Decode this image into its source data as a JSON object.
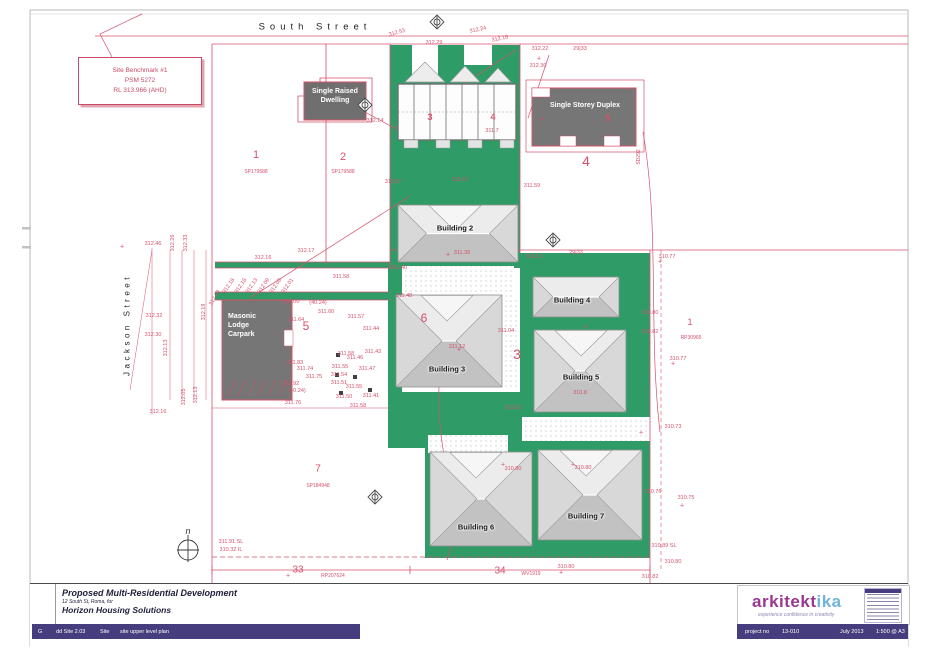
{
  "colors": {
    "line_pink": "#d6506b",
    "green": "#2f9c68",
    "dark_gray": "#767676",
    "purple_bar": "#453d7d",
    "logo_magenta": "#9a3890",
    "logo_cyan": "#72b5d8"
  },
  "plan": {
    "streets": {
      "top": "South Street",
      "left": "Jackson Street"
    },
    "benchmark": [
      "Site Benchmark #1",
      "PSM 5272",
      "RL 313.966 (AHD)"
    ],
    "areas": {
      "single_raised_dwelling": "Single Raised Dwelling",
      "single_storey_duplex": "Single Storey Duplex",
      "masonic_carpark": "Masonic Lodge Carpark"
    },
    "north_label": "n",
    "buildings": [
      {
        "label": "Building 2",
        "x": 398,
        "y": 205,
        "w": 120,
        "h": 57,
        "lx": 455,
        "ly": 228,
        "g": true
      },
      {
        "label": "Building 3",
        "x": 396,
        "y": 295,
        "w": 106,
        "h": 92,
        "lx": 447,
        "ly": 369,
        "g": true
      },
      {
        "label": "Building 4",
        "x": 533,
        "y": 277,
        "w": 86,
        "h": 40,
        "lx": 572,
        "ly": 300,
        "g": false
      },
      {
        "label": "Building 5",
        "x": 534,
        "y": 330,
        "w": 92,
        "h": 82,
        "lx": 581,
        "ly": 377,
        "g": true
      },
      {
        "label": "Building 6",
        "x": 430,
        "y": 452,
        "w": 102,
        "h": 94,
        "lx": 476,
        "ly": 527,
        "g": true
      },
      {
        "label": "Building 7",
        "x": 538,
        "y": 450,
        "w": 104,
        "h": 90,
        "lx": 586,
        "ly": 516,
        "g": true
      }
    ],
    "lot_numbers": [
      [
        "1",
        256,
        155,
        11
      ],
      [
        "2",
        343,
        157,
        11
      ],
      [
        "4",
        586,
        161,
        14
      ],
      [
        "5",
        306,
        326,
        12
      ],
      [
        "6",
        424,
        318,
        12
      ],
      [
        "3",
        517,
        354,
        14
      ],
      [
        "7",
        318,
        469,
        10
      ],
      [
        "33",
        298,
        570,
        10
      ],
      [
        "34",
        500,
        571,
        10
      ],
      [
        "1",
        690,
        322,
        9
      ]
    ],
    "plan_refs": [
      [
        "SP179588",
        256,
        172,
        0
      ],
      [
        "SP179588",
        343,
        172,
        0
      ],
      [
        "SP184948",
        318,
        486,
        0
      ],
      [
        "RP207624",
        333,
        576,
        0
      ],
      [
        "WV1919",
        531,
        574,
        0
      ],
      [
        "RP30965",
        691,
        338,
        0
      ],
      [
        "SD292",
        639,
        157,
        -90
      ]
    ],
    "unit_numbers": [
      [
        "3",
        430,
        117
      ],
      [
        "4",
        493,
        117
      ],
      [
        "5",
        608,
        118
      ]
    ],
    "survey_labels": [
      [
        "312.53",
        397,
        33,
        -15
      ],
      [
        "312.29",
        434,
        43
      ],
      [
        "312.24",
        478,
        30,
        -12
      ],
      [
        "312.16",
        500,
        39,
        -12
      ],
      [
        "312.22",
        540,
        49
      ],
      [
        "29|33",
        580,
        49
      ],
      [
        "312.30",
        538,
        66
      ],
      [
        "312.14",
        375,
        121
      ],
      [
        "311.7",
        492,
        131
      ],
      [
        "312.46",
        153,
        244
      ],
      [
        "312.26",
        173,
        243,
        -90
      ],
      [
        "312.33",
        186,
        243,
        -90
      ],
      [
        "312.16",
        263,
        258
      ],
      [
        "312.17",
        306,
        251
      ],
      [
        "311.58",
        341,
        277
      ],
      [
        "312.18",
        229,
        286,
        -55
      ],
      [
        "312.18",
        241,
        286,
        -55
      ],
      [
        "312.13",
        252,
        286,
        -55
      ],
      [
        "312.09",
        264,
        286,
        -55
      ],
      [
        "312.08",
        276,
        286,
        -55
      ],
      [
        "312.01",
        288,
        286,
        -55
      ],
      [
        "312.00",
        291,
        302
      ],
      [
        "(40.24)",
        318,
        303
      ],
      [
        "311.60",
        326,
        312
      ],
      [
        "311.64",
        296,
        320
      ],
      [
        "312.32",
        154,
        316
      ],
      [
        "312.30",
        153,
        335
      ],
      [
        "312.19",
        204,
        312,
        -90
      ],
      [
        "312.29",
        215,
        298,
        -60
      ],
      [
        "312.13",
        166,
        348,
        -90
      ],
      [
        "311.83",
        295,
        363
      ],
      [
        "311.74",
        305,
        369
      ],
      [
        "311.75",
        314,
        377
      ],
      [
        "311.92",
        291,
        384
      ],
      [
        "(40.24)",
        297,
        391
      ],
      [
        "311.76",
        293,
        403
      ],
      [
        "312.05",
        184,
        397,
        -90
      ],
      [
        "312.13",
        196,
        395,
        -90
      ],
      [
        "312.16",
        158,
        412
      ],
      [
        "311.87",
        393,
        182
      ],
      [
        "311.67",
        460,
        180
      ],
      [
        "311.59",
        532,
        186
      ],
      [
        "311.39",
        462,
        253
      ],
      [
        "311.12",
        534,
        257
      ],
      [
        "29|33",
        576,
        253
      ],
      [
        "310.77",
        667,
        257
      ],
      [
        "311.40",
        399,
        268
      ],
      [
        "311.48",
        404,
        296
      ],
      [
        "311.57",
        356,
        317
      ],
      [
        "311.44",
        371,
        329
      ],
      [
        "311.58",
        346,
        354
      ],
      [
        "311.43",
        373,
        352
      ],
      [
        "311.46",
        355,
        358
      ],
      [
        "311.55",
        340,
        367
      ],
      [
        "311.54",
        339,
        375
      ],
      [
        "311.47",
        367,
        369
      ],
      [
        "311.51",
        339,
        383
      ],
      [
        "311.55",
        354,
        387
      ],
      [
        "311.50",
        344,
        397
      ],
      [
        "311.41",
        371,
        396
      ],
      [
        "311.58",
        358,
        406
      ],
      [
        "311.12",
        457,
        347
      ],
      [
        "311.04",
        506,
        331
      ],
      [
        "311.03",
        513,
        408
      ],
      [
        "310.8",
        580,
        393
      ],
      [
        "310.80",
        650,
        313
      ],
      [
        "310.82",
        650,
        332
      ],
      [
        "310.77",
        678,
        359
      ],
      [
        "310.73",
        673,
        427
      ],
      [
        "310.76",
        653,
        492
      ],
      [
        "310.75",
        686,
        498
      ],
      [
        "310.89 SL",
        664,
        546
      ],
      [
        "310.80",
        673,
        562
      ],
      [
        "310.82",
        650,
        577
      ],
      [
        "310.80",
        513,
        469
      ],
      [
        "310.80",
        583,
        468
      ],
      [
        "310.80",
        566,
        567
      ],
      [
        "311.91 SL",
        231,
        542
      ],
      [
        "310.32 IL",
        231,
        550
      ],
      [
        "+",
        122,
        247,
        0,
        7
      ],
      [
        "+",
        539,
        59,
        0,
        7
      ],
      [
        "+",
        542,
        120,
        0,
        7
      ],
      [
        "+",
        448,
        255,
        0,
        7
      ],
      [
        "+",
        660,
        262,
        0,
        7
      ],
      [
        "+",
        673,
        364,
        0,
        7
      ],
      [
        "+",
        641,
        433,
        0,
        7
      ],
      [
        "+",
        682,
        506,
        0,
        7
      ],
      [
        "+",
        561,
        573,
        0,
        7
      ],
      [
        "+",
        288,
        576,
        0,
        7
      ],
      [
        "+",
        459,
        350,
        0,
        7
      ],
      [
        "+",
        585,
        327,
        0,
        7
      ],
      [
        "+",
        503,
        465,
        0,
        7
      ],
      [
        "+",
        573,
        465,
        0,
        7
      ]
    ],
    "survey_markers": [
      [
        437,
        22
      ],
      [
        365,
        105
      ],
      [
        553,
        240
      ],
      [
        375,
        497
      ]
    ],
    "tree_marks": [
      [
        338,
        355
      ],
      [
        337,
        375
      ],
      [
        355,
        377
      ],
      [
        370,
        390
      ],
      [
        341,
        393
      ]
    ]
  },
  "title_block": {
    "title": "Proposed Multi-Residential Development",
    "subtitle": "12 South St, Roma, for",
    "client": "Horizon Housing Solutions",
    "revision": "G",
    "doc_code": "dd Site 2.03",
    "phase": "Site",
    "sheet_name": "site upper level plan",
    "logo_main": "arkitekt",
    "logo_accent": "ika",
    "tagline": "experience confidence in creativity",
    "project_no_label": "project no",
    "project_no": "13-010",
    "date": "July 2013",
    "scale": "1:500 @ A3"
  }
}
